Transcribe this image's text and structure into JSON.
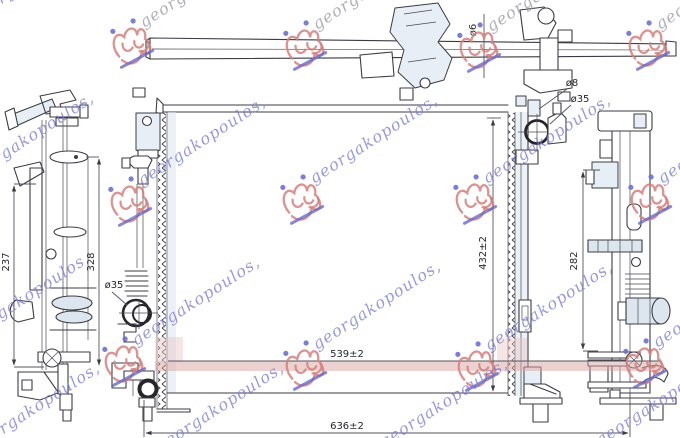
{
  "drawing_kind": "radiator-technical-drawing",
  "dimensions": {
    "left_view_height_outer": "237",
    "left_view_height_inner": "328",
    "core_height": "432±2",
    "core_width": "539±2",
    "overall_width": "636±2",
    "right_view_height": "282",
    "top_pipe_diameter": "ø6",
    "bleed_screw_diameter": "ø8",
    "inlet_diameter": "ø35",
    "outlet_diameter": "ø35"
  },
  "watermark": {
    "text": "georgakopoulos,",
    "logo": "georgakopoulos-monogram",
    "colors": {
      "logo_red": "#d4807d",
      "text_blue": "#7d7dd4",
      "text_gray": "#a2a2ac",
      "underline_blue": "#6a6ac8"
    }
  },
  "colors": {
    "line": "#3c3c44",
    "light_blue_fill": "#dde6ef",
    "highlight_band_pink": "#d9a3a3",
    "background": "#ffffff"
  }
}
